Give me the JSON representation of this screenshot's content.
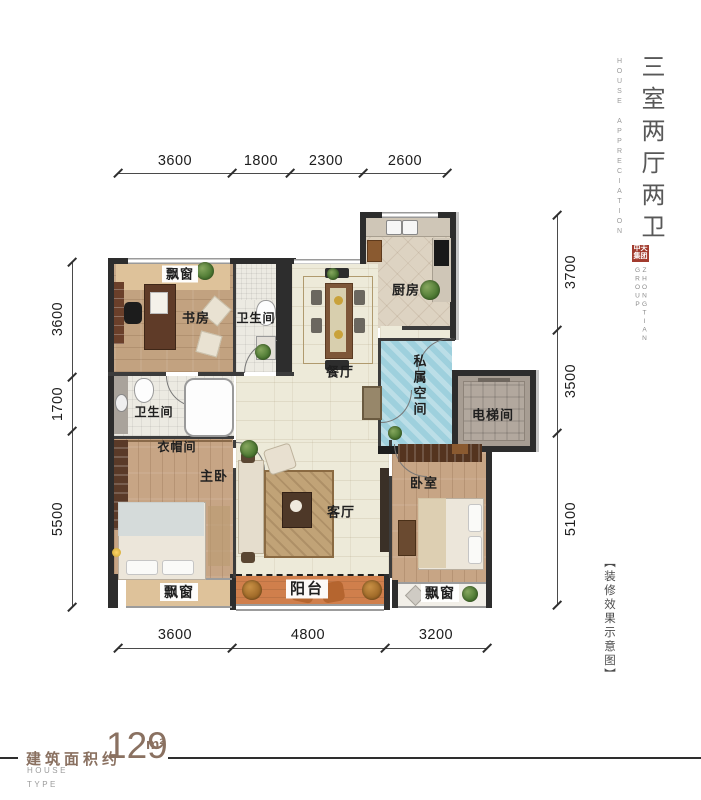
{
  "title_block": {
    "main_title": "三室两厅两卫",
    "subtitle": "HOUSE APPRECIATION",
    "logo_seal": "中天集团",
    "logo_name": "ZHONGTIAN GROUP",
    "note": "【装修效果示意图】"
  },
  "dimensions": {
    "top": [
      "3600",
      "1800",
      "2300",
      "2600"
    ],
    "left": [
      "3600",
      "1700",
      "5500"
    ],
    "right": [
      "3700",
      "3500",
      "5100"
    ],
    "bottom": [
      "3600",
      "4800",
      "3200"
    ]
  },
  "rooms": {
    "bay_window_top": "飘窗",
    "study": "书房",
    "bath_top": "卫生间",
    "kitchen": "厨房",
    "dining": "餐厅",
    "private_space": "私属空间",
    "elevator": "电梯间",
    "bath_mid": "卫生间",
    "cloakroom": "衣帽间",
    "master_bedroom": "主卧",
    "living": "客厅",
    "bedroom": "卧室",
    "balcony": "阳台",
    "bay_window_left": "飘窗",
    "bay_window_right": "飘窗"
  },
  "footer": {
    "area_label": "建筑面积约",
    "area_value": "129",
    "area_unit": "m²",
    "house": "HOUSE",
    "type": "TYPE"
  },
  "colors": {
    "private_space_blue": "#9ed0dd",
    "balcony_orange": "#d07f4c",
    "wood_floor": "#c7a585",
    "seal_red": "#a23b2e",
    "area_text_brown": "#8a7161",
    "wall_dark": "#2d2d2d"
  }
}
